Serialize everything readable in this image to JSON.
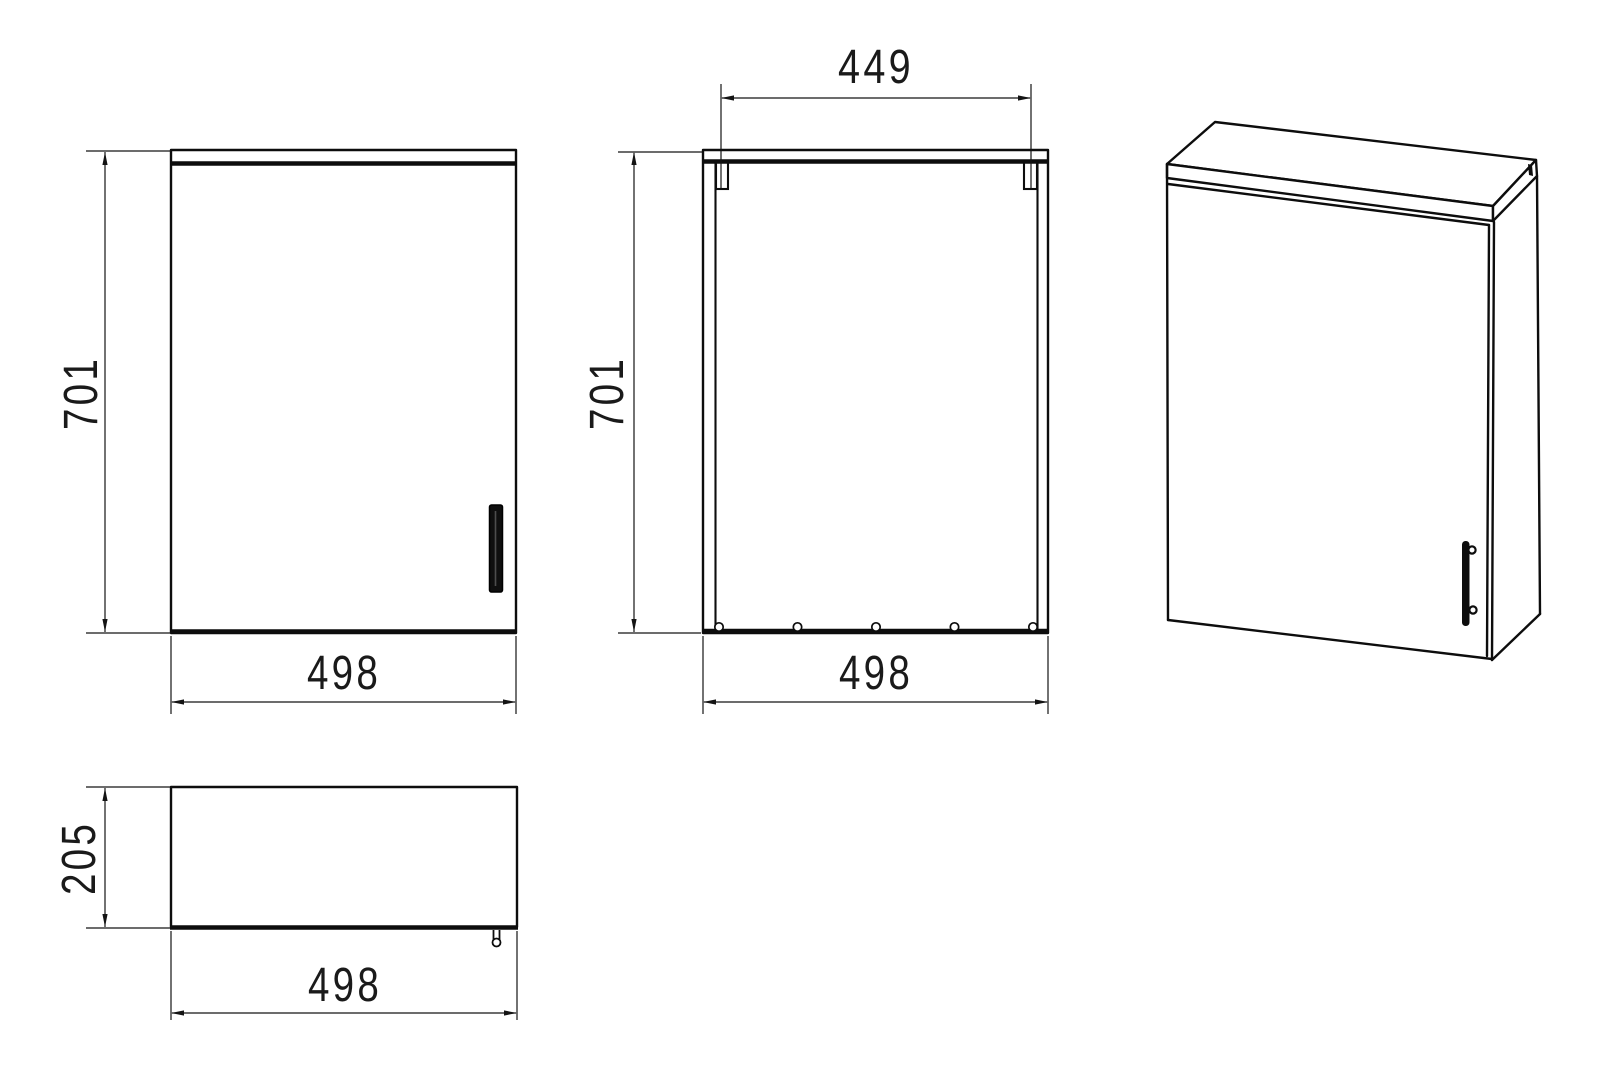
{
  "drawing": {
    "background": "#ffffff",
    "line_color": "#0d0d0d",
    "views": {
      "front": {
        "height_label": "701",
        "width_label": "498"
      },
      "back": {
        "top_span_label": "449",
        "height_label": "701",
        "width_label": "498"
      },
      "plan": {
        "depth_label": "205",
        "width_label": "498"
      },
      "isometric": {}
    }
  }
}
